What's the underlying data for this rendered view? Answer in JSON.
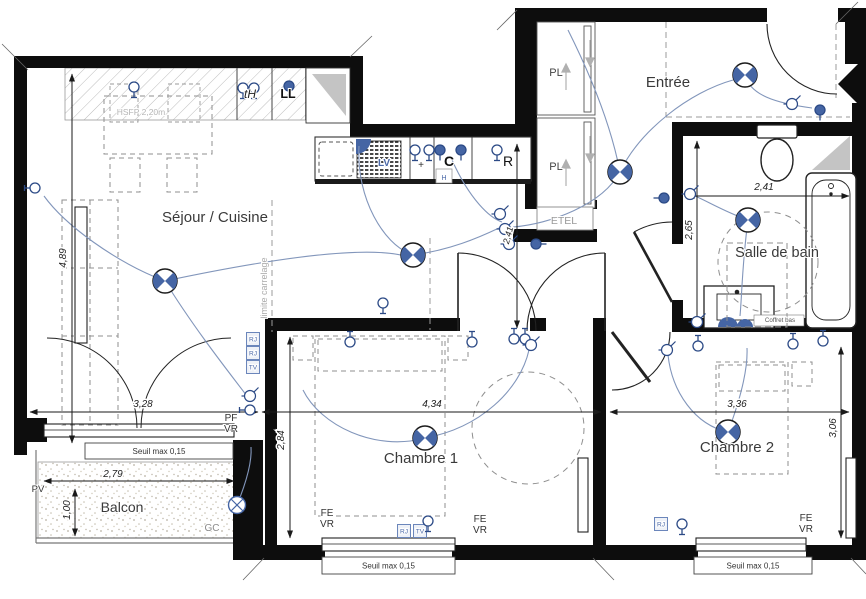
{
  "meta": {
    "type": "architectural-floor-plan",
    "language": "fr"
  },
  "colors": {
    "wall": "#0d0d0d",
    "symbol_blue": "#4565a4",
    "symbol_stroke": "#2c4a86",
    "wire": "#8296bb",
    "dash_gray": "#9b9b9b",
    "text_dark": "#333333",
    "text_gray": "#9a9a9a",
    "text_light_gray": "#b5b5b5",
    "label_blue": "#4b69a8"
  },
  "icons": {
    "ceiling-light": "circle-with-blue-bowtie-quadrants",
    "wall-light": "circle-with-x-cross",
    "outlet": "circle-with-wall-stem",
    "outlet-filled": "filled-blue-circle-with-stem",
    "switch": "circle-with-diagonal-tick"
  },
  "rooms": [
    {
      "name": "sejour-cuisine",
      "label": "Séjour / Cuisine",
      "x": 215,
      "y": 222,
      "size": 15
    },
    {
      "name": "entree",
      "label": "Entrée",
      "x": 668,
      "y": 87,
      "size": 15
    },
    {
      "name": "salle-de-bain",
      "label": "Salle de bain",
      "x": 777,
      "y": 257,
      "size": 14.5
    },
    {
      "name": "chambre-1",
      "label": "Chambre 1",
      "x": 421,
      "y": 463,
      "size": 15
    },
    {
      "name": "chambre-2",
      "label": "Chambre 2",
      "x": 737,
      "y": 452,
      "size": 15
    },
    {
      "name": "balcon",
      "label": "Balcon",
      "x": 122,
      "y": 512,
      "size": 14
    }
  ],
  "dimensions": [
    {
      "text": "4,89",
      "x": 66,
      "y": 258,
      "rot": -90,
      "size": 10
    },
    {
      "text": "3,28",
      "x": 143,
      "y": 407,
      "rot": 0,
      "size": 10
    },
    {
      "text": "4,34",
      "x": 432,
      "y": 407,
      "rot": 0,
      "size": 10
    },
    {
      "text": "3,36",
      "x": 737,
      "y": 407,
      "rot": 0,
      "size": 10
    },
    {
      "text": "2,84",
      "x": 284,
      "y": 440,
      "rot": -90,
      "size": 10
    },
    {
      "text": "3,06",
      "x": 836,
      "y": 428,
      "rot": -90,
      "size": 10
    },
    {
      "text": "2,79",
      "x": 113,
      "y": 477,
      "rot": 0,
      "size": 10
    },
    {
      "text": "1,00",
      "x": 70,
      "y": 510,
      "rot": -90,
      "size": 10
    },
    {
      "text": "2,41",
      "x": 764,
      "y": 190,
      "rot": 0,
      "size": 10
    },
    {
      "text": "2,65",
      "x": 692,
      "y": 230,
      "rot": -90,
      "size": 10
    },
    {
      "text": "2,41",
      "x": 511,
      "y": 236,
      "rot": -75,
      "size": 9
    }
  ],
  "small_labels": [
    {
      "text": "PL",
      "x": 556,
      "y": 76,
      "size": 11,
      "color": "#444444"
    },
    {
      "text": "PL",
      "x": 556,
      "y": 170,
      "size": 11,
      "color": "#444444"
    },
    {
      "text": "ETEL",
      "x": 564,
      "y": 224,
      "size": 10.5,
      "color": "#9a9a9a"
    },
    {
      "text": "tH",
      "x": 250,
      "y": 98,
      "size": 12,
      "color": "#222222",
      "italic": true
    },
    {
      "text": "LL",
      "x": 288,
      "y": 98,
      "size": 12.5,
      "color": "#111111",
      "weight": 600
    },
    {
      "text": "C",
      "x": 449,
      "y": 166,
      "size": 14,
      "color": "#111111",
      "weight": 600
    },
    {
      "text": "R",
      "x": 508,
      "y": 166,
      "size": 14,
      "color": "#111111"
    },
    {
      "text": "LV",
      "x": 384,
      "y": 166,
      "size": 10,
      "color": "#4b69a8",
      "weight": 600
    },
    {
      "text": "H",
      "x": 444,
      "y": 180,
      "size": 7,
      "color": "#4b69a8"
    },
    {
      "text": "+",
      "x": 421,
      "y": 168,
      "size": 10,
      "color": "#333333"
    },
    {
      "text": "HSFP 2,20m",
      "x": 141,
      "y": 115,
      "size": 8.5,
      "color": "#b5b5b5"
    },
    {
      "text": "limite carrelage",
      "x": 267,
      "y": 288,
      "size": 9,
      "color": "#ababab",
      "rot": -90
    },
    {
      "text": "Coffret bas",
      "x": 780,
      "y": 322,
      "size": 6.2,
      "color": "#555555"
    },
    {
      "text": "PF",
      "x": 231,
      "y": 421,
      "size": 10,
      "color": "#333333"
    },
    {
      "text": "VR",
      "x": 231,
      "y": 432,
      "size": 10,
      "color": "#333333"
    },
    {
      "text": "FE",
      "x": 327,
      "y": 516,
      "size": 10,
      "color": "#333333"
    },
    {
      "text": "VR",
      "x": 327,
      "y": 527,
      "size": 10,
      "color": "#333333"
    },
    {
      "text": "FE",
      "x": 480,
      "y": 522,
      "size": 10,
      "color": "#333333"
    },
    {
      "text": "VR",
      "x": 480,
      "y": 533,
      "size": 10,
      "color": "#333333"
    },
    {
      "text": "FE",
      "x": 806,
      "y": 521,
      "size": 10,
      "color": "#333333"
    },
    {
      "text": "VR",
      "x": 806,
      "y": 532,
      "size": 10,
      "color": "#333333"
    },
    {
      "text": "PV",
      "x": 38,
      "y": 492,
      "size": 9.5,
      "color": "#333333"
    },
    {
      "text": "GC",
      "x": 212,
      "y": 531,
      "size": 10,
      "color": "#8a8a8a"
    }
  ],
  "seuil_boxes": [
    {
      "text": "Seuil max 0,15",
      "x": 85,
      "y": 443,
      "w": 148,
      "h": 16
    },
    {
      "text": "Seuil max 0,15",
      "x": 322,
      "y": 557,
      "w": 133,
      "h": 17
    },
    {
      "text": "Seuil max 0,15",
      "x": 694,
      "y": 557,
      "w": 118,
      "h": 17
    }
  ],
  "wall_squares": [
    {
      "text": "RJ",
      "x": 253,
      "y": 339
    },
    {
      "text": "RJ",
      "x": 253,
      "y": 353
    },
    {
      "text": "TV",
      "x": 253,
      "y": 367
    },
    {
      "text": "RJ",
      "x": 404,
      "y": 531
    },
    {
      "text": "TV",
      "x": 420,
      "y": 531
    },
    {
      "text": "RJ",
      "x": 661,
      "y": 524
    }
  ],
  "symbols": {
    "ceiling_lights": [
      {
        "x": 165,
        "y": 281
      },
      {
        "x": 413,
        "y": 255
      },
      {
        "x": 620,
        "y": 172
      },
      {
        "x": 745,
        "y": 75
      },
      {
        "x": 748,
        "y": 220
      },
      {
        "x": 425,
        "y": 438
      },
      {
        "x": 728,
        "y": 432
      }
    ],
    "wall_lights": [
      {
        "x": 237,
        "y": 505
      }
    ],
    "outlets": [
      {
        "x": 35,
        "y": 188,
        "rot": 90
      },
      {
        "x": 134,
        "y": 87,
        "rot": 0
      },
      {
        "x": 243,
        "y": 88,
        "rot": 0
      },
      {
        "x": 254,
        "y": 88,
        "rot": 0
      },
      {
        "x": 289,
        "y": 86,
        "rot": 0,
        "filled": true
      },
      {
        "x": 415,
        "y": 150,
        "rot": 0
      },
      {
        "x": 429,
        "y": 150,
        "rot": 0
      },
      {
        "x": 440,
        "y": 150,
        "rot": 0,
        "filled": true
      },
      {
        "x": 461,
        "y": 150,
        "rot": 0,
        "filled": true
      },
      {
        "x": 497,
        "y": 150,
        "rot": 0
      },
      {
        "x": 383,
        "y": 303,
        "rot": 0
      },
      {
        "x": 350,
        "y": 342,
        "rot": 180
      },
      {
        "x": 472,
        "y": 342,
        "rot": 180
      },
      {
        "x": 514,
        "y": 339,
        "rot": 180
      },
      {
        "x": 525,
        "y": 339,
        "rot": 180
      },
      {
        "x": 428,
        "y": 521,
        "rot": 0
      },
      {
        "x": 682,
        "y": 524,
        "rot": 0
      },
      {
        "x": 698,
        "y": 346,
        "rot": 180
      },
      {
        "x": 793,
        "y": 344,
        "rot": 180
      },
      {
        "x": 823,
        "y": 341,
        "rot": 180
      },
      {
        "x": 664,
        "y": 198,
        "rot": 90,
        "filled": true
      },
      {
        "x": 820,
        "y": 110,
        "rot": 0,
        "filled": true
      },
      {
        "x": 536,
        "y": 244,
        "rot": -90,
        "filled": true
      },
      {
        "x": 250,
        "y": 410,
        "rot": 90
      }
    ],
    "switches": [
      {
        "x": 500,
        "y": 214
      },
      {
        "x": 505,
        "y": 229
      },
      {
        "x": 509,
        "y": 244
      },
      {
        "x": 792,
        "y": 104
      },
      {
        "x": 690,
        "y": 194
      },
      {
        "x": 697,
        "y": 322
      },
      {
        "x": 531,
        "y": 345
      },
      {
        "x": 667,
        "y": 350
      },
      {
        "x": 250,
        "y": 396
      }
    ]
  }
}
